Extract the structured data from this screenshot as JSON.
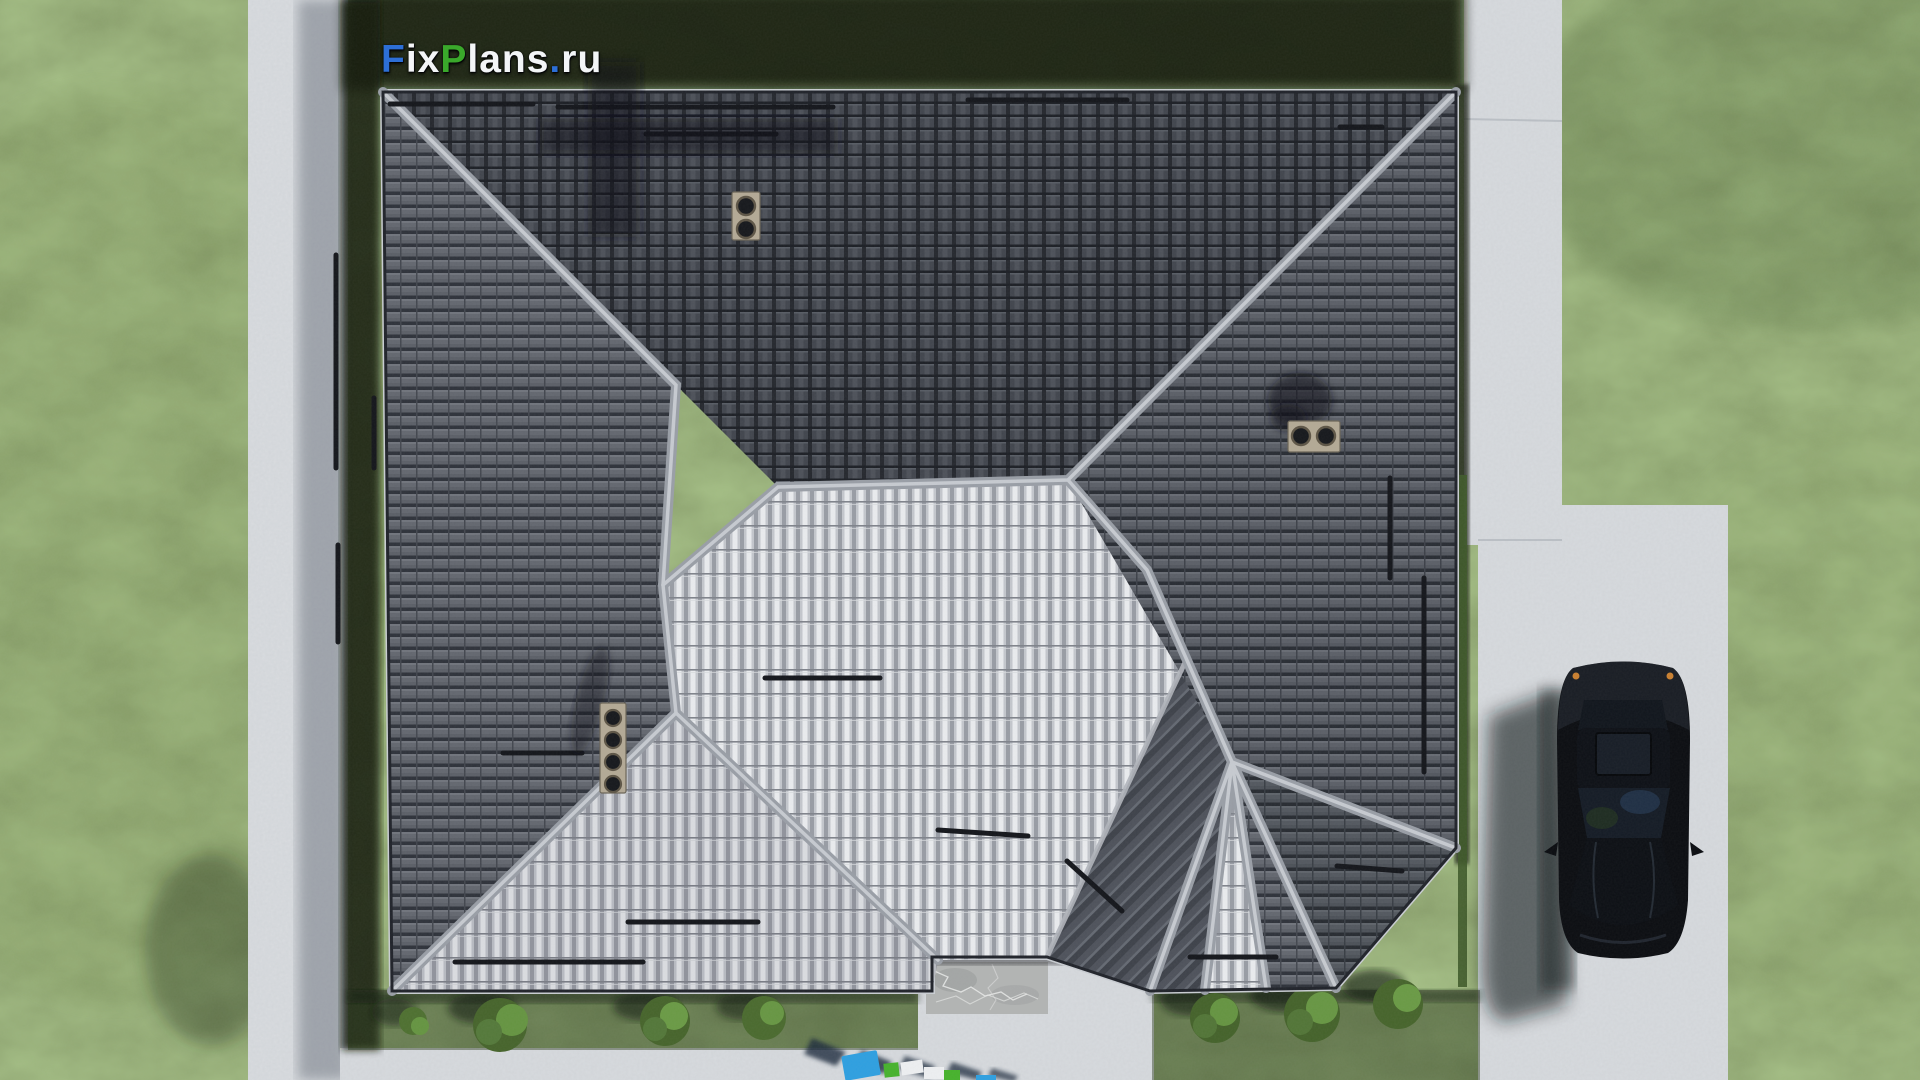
{
  "watermark": {
    "text": "FixPlans.ru",
    "parts": [
      {
        "text": "F",
        "color": "#2d6fd6"
      },
      {
        "text": "ix",
        "color": "#f3f5f7"
      },
      {
        "text": "P",
        "color": "#3aa82b"
      },
      {
        "text": "lans",
        "color": "#f3f5f7"
      },
      {
        "text": ".",
        "color": "#2d6fd6"
      },
      {
        "text": "ru",
        "color": "#f3f5f7"
      }
    ]
  },
  "scene": {
    "type": "aerial-3d-render",
    "subject": "top-down view of hip-roof house with lawn, garden paths, driveway and parked black car",
    "palette": {
      "grassBase": "#4f6837",
      "grassStrip": "#2c3c1e",
      "grassShadow": "#131a0f",
      "hedgeGreen": "#3f5a2a",
      "concrete": "#c7cbd0",
      "concreteShadow": "#5c6470",
      "roofDark": "#42464e",
      "roofMedium": "#5a5e66",
      "roofBright": "#c6c9cf",
      "ridge": "#999ea6",
      "ridgeHighlight": "#c6cad0",
      "eaveLine": "#20232a",
      "snowGuard": "#14161b",
      "ventPlate": "#b3a995",
      "stoneSlab": "#b2b4b3",
      "carBody": "#0b0d11",
      "carGlass": "#141b25",
      "accentAmber": "#c97f2f",
      "blockBlue": "#2e9fe0",
      "blockGreen": "#46b22c",
      "blockWhite": "#edeff1"
    },
    "objects": [
      "lawn",
      "left-garden-path",
      "bottom-garden-path",
      "patio-walkway",
      "porch-stone-slab",
      "sidewalk",
      "driveway",
      "house-roof",
      "ridge-lines",
      "snow-guards",
      "roof-vents",
      "bushes",
      "parked-car",
      "logo-blocks"
    ]
  }
}
